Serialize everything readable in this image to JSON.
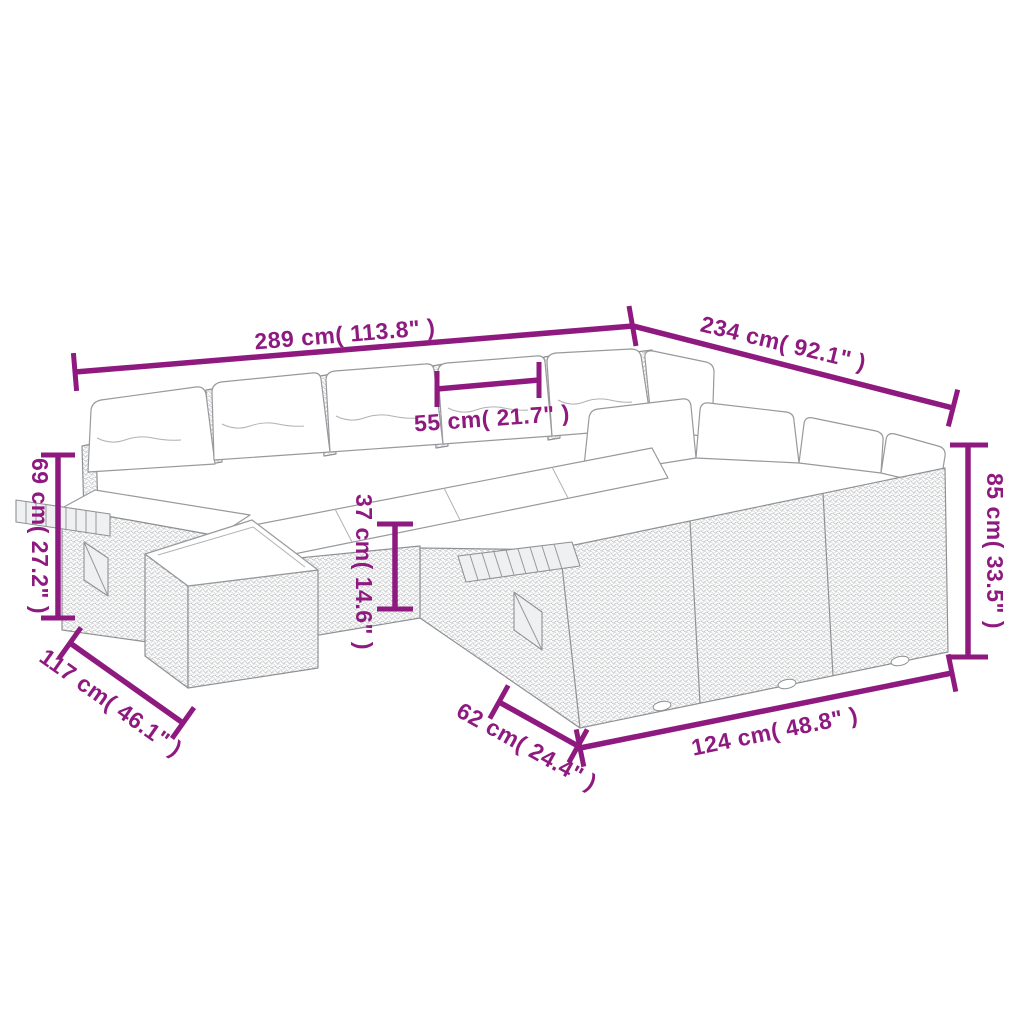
{
  "diagram": {
    "title": "garden-sofa-set-dimension-diagram",
    "colors": {
      "dimension_accent": "#8e1a80",
      "artwork_line": "#97999c",
      "background": "#ffffff"
    },
    "dimensions": {
      "back_width": {
        "label": "289 cm( 113.8\" )"
      },
      "right_depth": {
        "label": "234 cm( 92.1\" )"
      },
      "seat_width": {
        "label": "55 cm( 21.7\" )"
      },
      "armrest_height": {
        "label": "69 cm( 27.2\" )"
      },
      "seat_height": {
        "label": "37 cm( 14.6\" )"
      },
      "back_height": {
        "label": "85 cm( 33.5\" )"
      },
      "left_depth": {
        "label": "117 cm( 46.1\" )"
      },
      "ottoman_depth": {
        "label": "62 cm( 24.4\" )"
      },
      "front_width": {
        "label": "124 cm( 48.8\" )"
      }
    }
  }
}
